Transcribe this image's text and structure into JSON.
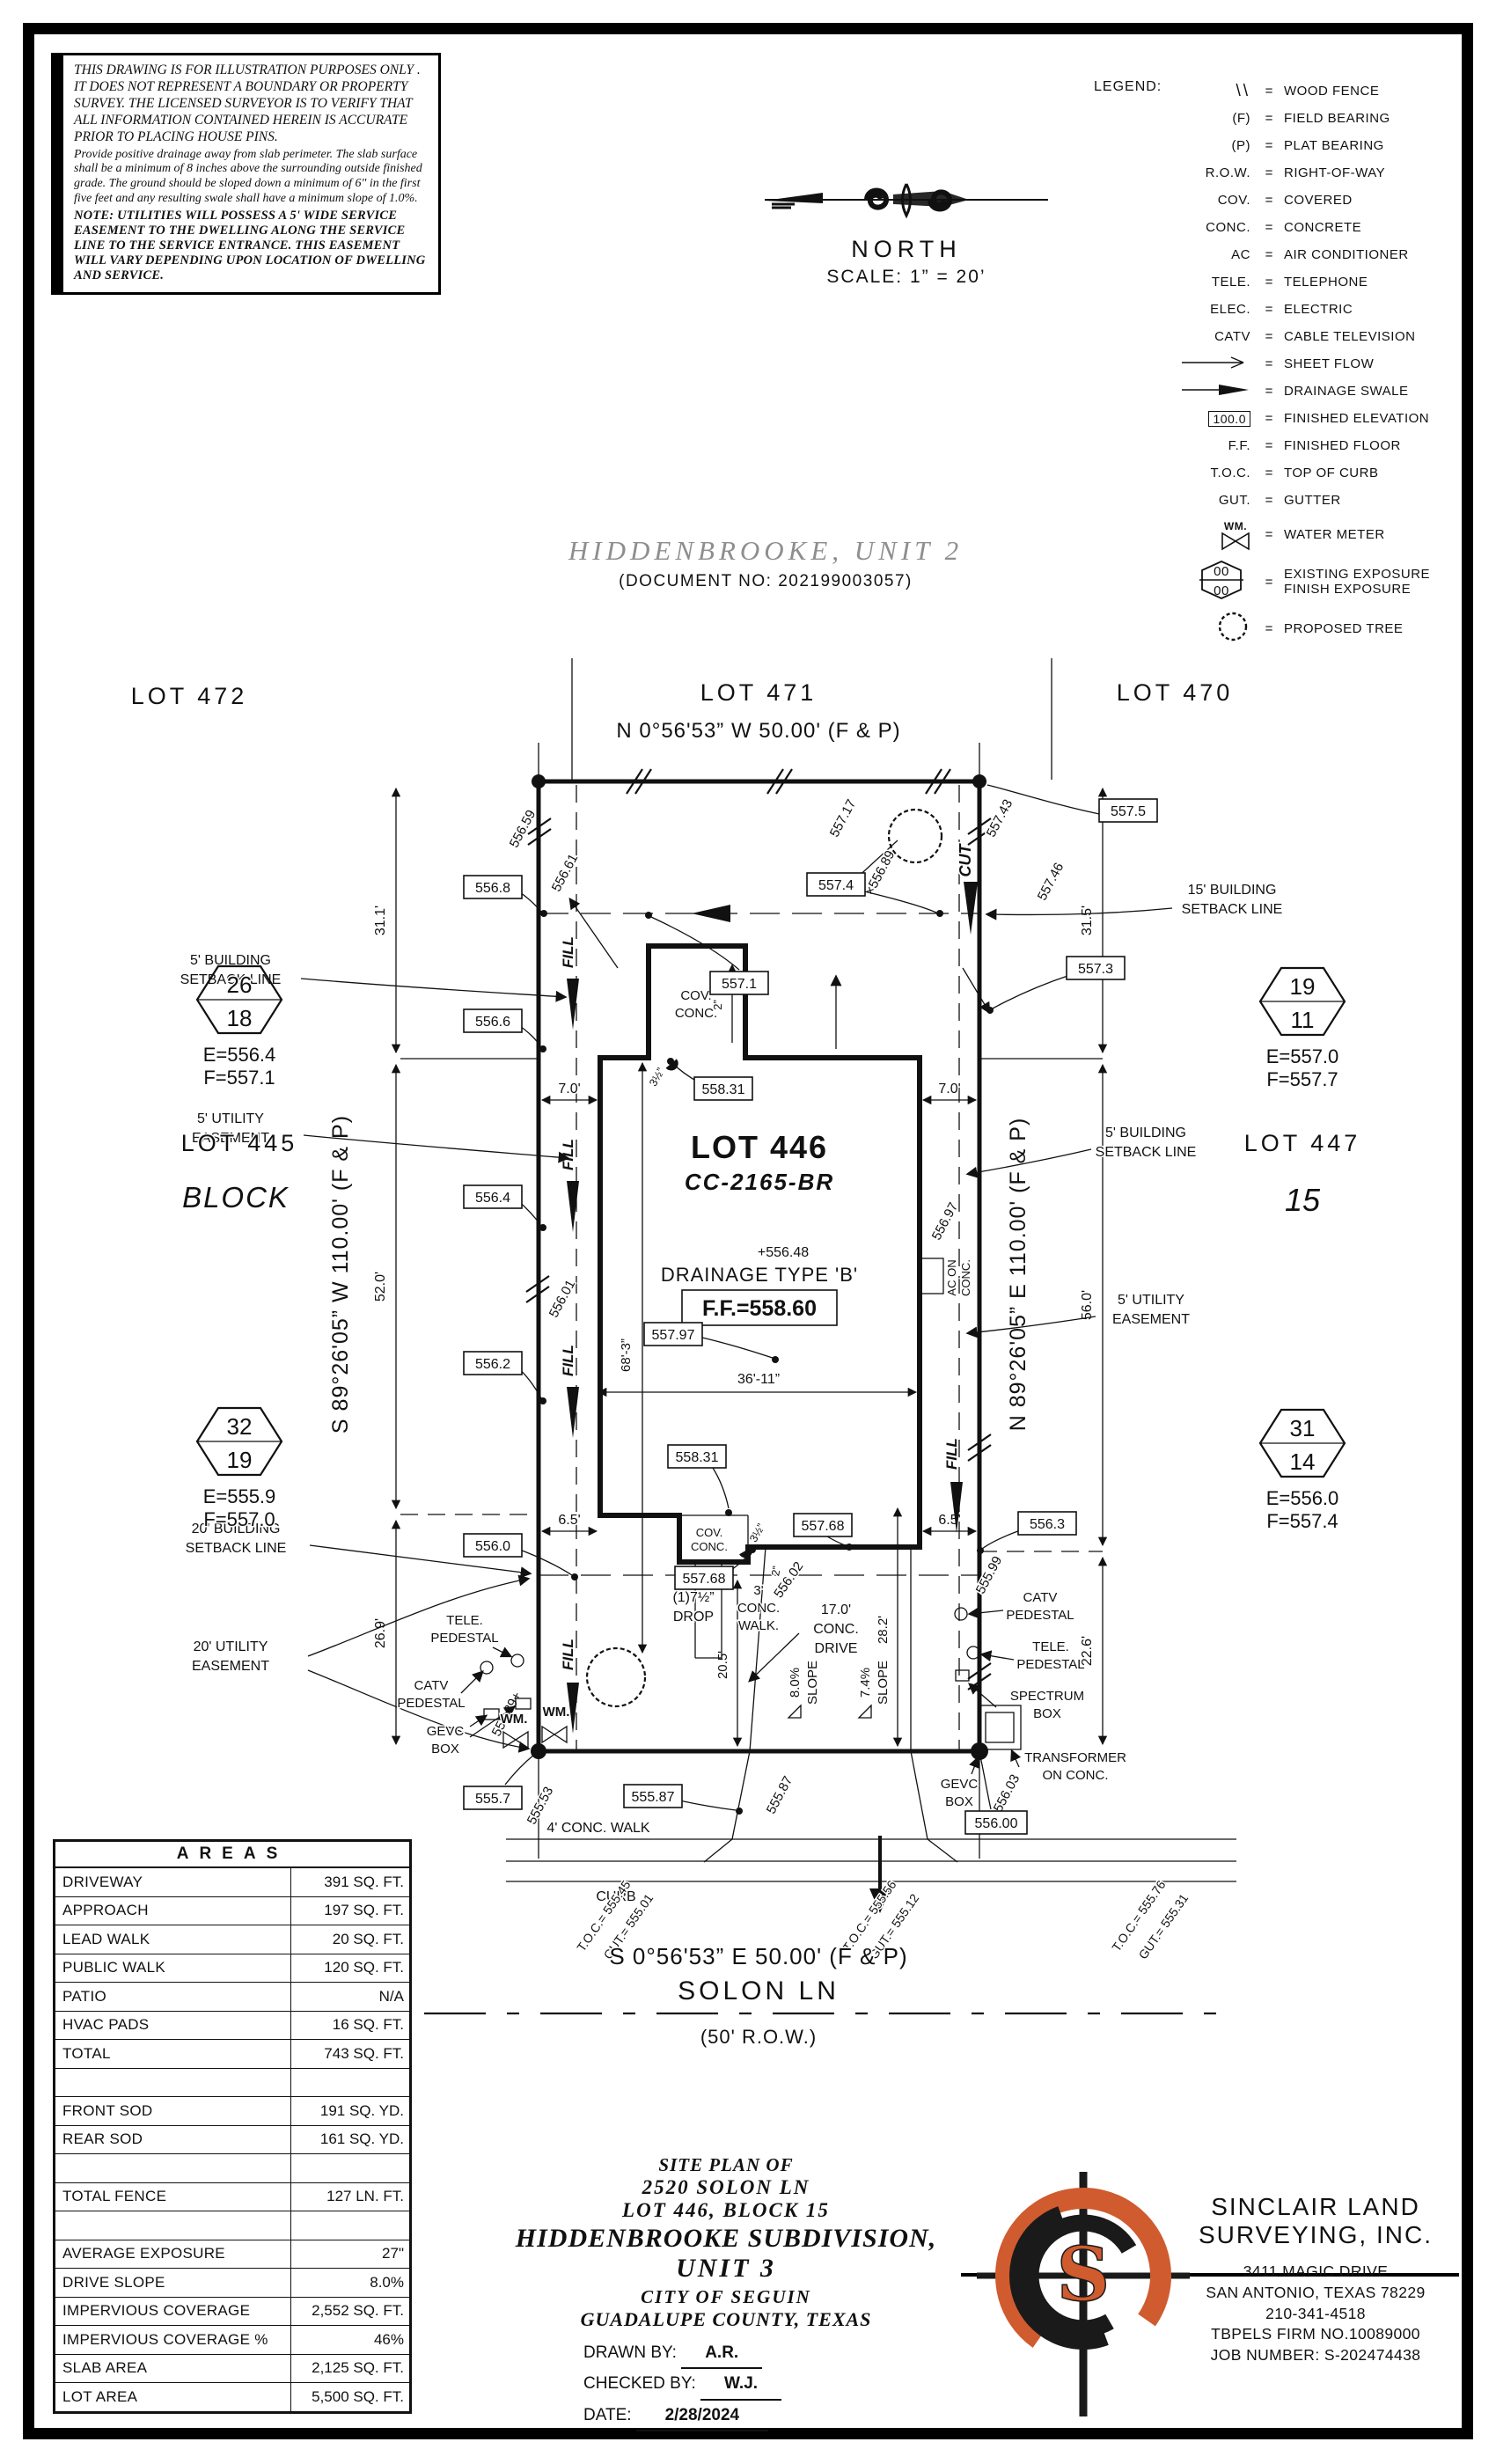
{
  "disclaimer": {
    "p1": "THIS DRAWING IS FOR ILLUSTRATION PURPOSES ONLY . IT DOES NOT REPRESENT A BOUNDARY OR PROPERTY SURVEY. THE LICENSED SURVEYOR IS TO VERIFY THAT ALL INFORMATION CONTAINED HEREIN IS ACCURATE PRIOR TO PLACING HOUSE PINS.",
    "p2": "Provide positive drainage away from slab perimeter. The slab surface shall be a minimum of 8 inches above the surrounding outside finished grade. The ground should be sloped down a minimum of 6\" in the first five feet and any resulting swale shall have a minimum slope of 1.0%.",
    "note": "NOTE: UTILITIES WILL POSSESS A 5' WIDE SERVICE EASEMENT TO THE DWELLING ALONG THE SERVICE LINE TO THE SERVICE ENTRANCE. THIS EASEMENT WILL VARY DEPENDING UPON LOCATION OF DWELLING AND SERVICE."
  },
  "legend": {
    "title": "LEGEND:",
    "eq": "=",
    "items": [
      {
        "sym": "\\\\",
        "label": "WOOD FENCE"
      },
      {
        "sym": "(F)",
        "label": "FIELD BEARING"
      },
      {
        "sym": "(P)",
        "label": "PLAT BEARING"
      },
      {
        "sym": "R.O.W.",
        "label": "RIGHT-OF-WAY"
      },
      {
        "sym": "COV.",
        "label": "COVERED"
      },
      {
        "sym": "CONC.",
        "label": "CONCRETE"
      },
      {
        "sym": "AC",
        "label": "AIR CONDITIONER"
      },
      {
        "sym": "TELE.",
        "label": "TELEPHONE"
      },
      {
        "sym": "ELEC.",
        "label": "ELECTRIC"
      },
      {
        "sym": "CATV",
        "label": "CABLE TELEVISION"
      },
      {
        "sym": "",
        "label": "SHEET FLOW"
      },
      {
        "sym": "",
        "label": "DRAINAGE SWALE"
      },
      {
        "sym": "100.0",
        "label": "FINISHED ELEVATION"
      },
      {
        "sym": "F.F.",
        "label": "FINISHED FLOOR"
      },
      {
        "sym": "T.O.C.",
        "label": "TOP OF CURB"
      },
      {
        "sym": "GUT.",
        "label": "GUTTER"
      },
      {
        "sym": "WM.",
        "label": "WATER METER"
      },
      {
        "sym": "00",
        "label": "EXISTING EXPOSURE",
        "label2": "FINISH EXPOSURE"
      },
      {
        "sym": "",
        "label": "PROPOSED TREE"
      }
    ]
  },
  "north": {
    "label": "NORTH",
    "scale": "SCALE:  1”  =  20’"
  },
  "subdivision": {
    "title": "HIDDENBROOKE,  UNIT  2",
    "doc": "(DOCUMENT NO:  202199003057)"
  },
  "lots": {
    "top_left": "LOT 472",
    "top_mid": "LOT 471",
    "top_right": "LOT 470",
    "left": "LOT 445",
    "left_block": "BLOCK",
    "right": "LOT 447",
    "right_block": "15"
  },
  "bearings": {
    "top": "N 0°56'53” W 50.00' (F & P)",
    "left": "S 89°26'05” W 110.00' (F & P)",
    "right": "N 89°26'05” E 110.00' (F & P)",
    "bottom": "S 0°56'53” E 50.00' (F & P)"
  },
  "street": {
    "name": "SOLON LN",
    "row": "(50' R.O.W.)",
    "walk": "4' CONC. WALK",
    "curb": "CURB"
  },
  "markers": {
    "ul": {
      "top": "26",
      "bot": "18",
      "e": "E=556.4",
      "f": "F=557.1"
    },
    "ll": {
      "top": "32",
      "bot": "19",
      "e": "E=555.9",
      "f": "F=557.0"
    },
    "ur": {
      "top": "19",
      "bot": "11",
      "e": "E=557.0",
      "f": "F=557.7"
    },
    "lr": {
      "top": "31",
      "bot": "14",
      "e": "E=556.0",
      "f": "F=557.4"
    }
  },
  "plot": {
    "lot_label": "LOT 446",
    "plan_code": "CC-2165-BR",
    "spot_center": "+556.48",
    "drainage_type": "DRAINAGE TYPE 'B'",
    "finished_floor": "F.F.=558.60",
    "cut": "CUT",
    "fill": "FILL",
    "cov": "COV.",
    "conc": "CONC.",
    "ac_on": "AC ON",
    "ac_conc": "CONC.",
    "b557_5": "557.5",
    "b556_8": "556.8",
    "b557_4": "557.4",
    "b557_3": "557.3",
    "b557_1": "557.1",
    "b556_6": "556.6",
    "b558_31": "558.31",
    "b556_4": "556.4",
    "b557_97": "557.97",
    "b556_2": "556.2",
    "b557_68": "557.68",
    "b556_0": "556.0",
    "b556_3": "556.3",
    "b555_7": "555.7",
    "b555_87": "555.87",
    "b556_00": "556.00",
    "s556_59": "556.59",
    "s556_61": "556.61",
    "s557_17": "557.17",
    "s556_89": "×556.89",
    "s557_43": "557.43",
    "s557_46": "557.46",
    "s556_01": "556.01",
    "s555_89": "555.89+",
    "s555_53": "555.53",
    "s555_87": "555.87",
    "s556_02": "556.02",
    "s555_99": "555.99",
    "s556_03": "556.03",
    "s556_97": "556.97",
    "d31_1": "31.1'",
    "d31_5": "31.5'",
    "d52_0": "52.0'",
    "d56_0": "56.0'",
    "d26_9": "26.9'",
    "d22_6": "22.6'",
    "d7_0": "7.0'",
    "d6_5": "6.5'",
    "d68_3": "68'-3”",
    "d36_11": "36'-11”",
    "d20_5": "20.5'",
    "d28_2": "28.2'",
    "d2in": "2”",
    "d3half": "3½”",
    "setback5a": "5' BUILDING",
    "setback15a": "15' BUILDING",
    "setback20a": "20' BUILDING",
    "setback_b": "SETBACK LINE",
    "utility5a": "5' UTILITY",
    "utility20a": "20' UTILITY",
    "easement": "EASEMENT",
    "drop1": "(1)7½”",
    "drop2": "DROP",
    "walk3": "3'",
    "walk_conc": "CONC.",
    "walk_word": "WALK.",
    "drive17": "17.0'",
    "drive_conc": "CONC.",
    "drive_word": "DRIVE",
    "slope8": "8.0%",
    "slope7": "7.4%",
    "slope_word": "SLOPE",
    "tele": "TELE.",
    "pedestal": "PEDESTAL",
    "catv": "CATV",
    "gevc": "GEVC",
    "box_word": "BOX",
    "wm": "WM.",
    "spectrum": "SPECTRUM",
    "transformer": "TRANSFORMER",
    "on_conc": "ON CONC.",
    "toc1a": "T.O.C.= 555.45",
    "toc1b": "GUT.= 555.01",
    "toc2a": "T.O.C.= 555.56",
    "toc2b": "GUT.= 555.12",
    "toc3a": "T.O.C.= 555.76",
    "toc3b": "GUT.= 555.31"
  },
  "areas": {
    "title": "AREAS",
    "rows": [
      {
        "label": "DRIVEWAY",
        "value": "391 SQ. FT."
      },
      {
        "label": "APPROACH",
        "value": "197 SQ. FT."
      },
      {
        "label": "LEAD WALK",
        "value": "20 SQ. FT."
      },
      {
        "label": "PUBLIC WALK",
        "value": "120 SQ. FT."
      },
      {
        "label": "PATIO",
        "value": "N/A"
      },
      {
        "label": "HVAC PADS",
        "value": "16 SQ. FT."
      },
      {
        "label": "TOTAL",
        "value": "743 SQ. FT."
      },
      {
        "label": "",
        "value": ""
      },
      {
        "label": "FRONT SOD",
        "value": "191 SQ. YD."
      },
      {
        "label": "REAR SOD",
        "value": "161 SQ. YD."
      },
      {
        "label": "",
        "value": ""
      },
      {
        "label": "TOTAL FENCE",
        "value": "127 LN. FT."
      },
      {
        "label": "",
        "value": ""
      },
      {
        "label": "AVERAGE EXPOSURE",
        "value": "27\""
      },
      {
        "label": "DRIVE SLOPE",
        "value": "8.0%"
      },
      {
        "label": "IMPERVIOUS COVERAGE",
        "value": "2,552 SQ. FT."
      },
      {
        "label": "IMPERVIOUS COVERAGE %",
        "value": "46%"
      },
      {
        "label": "SLAB AREA",
        "value": "2,125 SQ. FT."
      },
      {
        "label": "LOT AREA",
        "value": "5,500 SQ. FT."
      }
    ]
  },
  "titleblock": {
    "l1": "SITE PLAN OF",
    "l2": "2520 SOLON LN",
    "l3": "LOT 446, BLOCK 15",
    "l4": "HIDDENBROOKE SUBDIVISION,",
    "l5": "UNIT 3",
    "l6": "CITY OF SEGUIN",
    "l7": "GUADALUPE COUNTY, TEXAS",
    "drawn_label": "DRAWN BY:",
    "drawn": "A.R.",
    "checked_label": "CHECKED BY:",
    "checked": "W.J.",
    "date_label": "DATE:",
    "date": "2/28/2024"
  },
  "company": {
    "name1": "SINCLAIR LAND",
    "name2": "SURVEYING, INC.",
    "addr1": "3411 MAGIC DRIVE",
    "addr2": "SAN ANTONIO, TEXAS 78229",
    "phone": "210-341-4518",
    "firm": "TBPELS FIRM NO.10089000",
    "job": "JOB NUMBER: S-202474438",
    "accent": "#cf5b2e"
  }
}
